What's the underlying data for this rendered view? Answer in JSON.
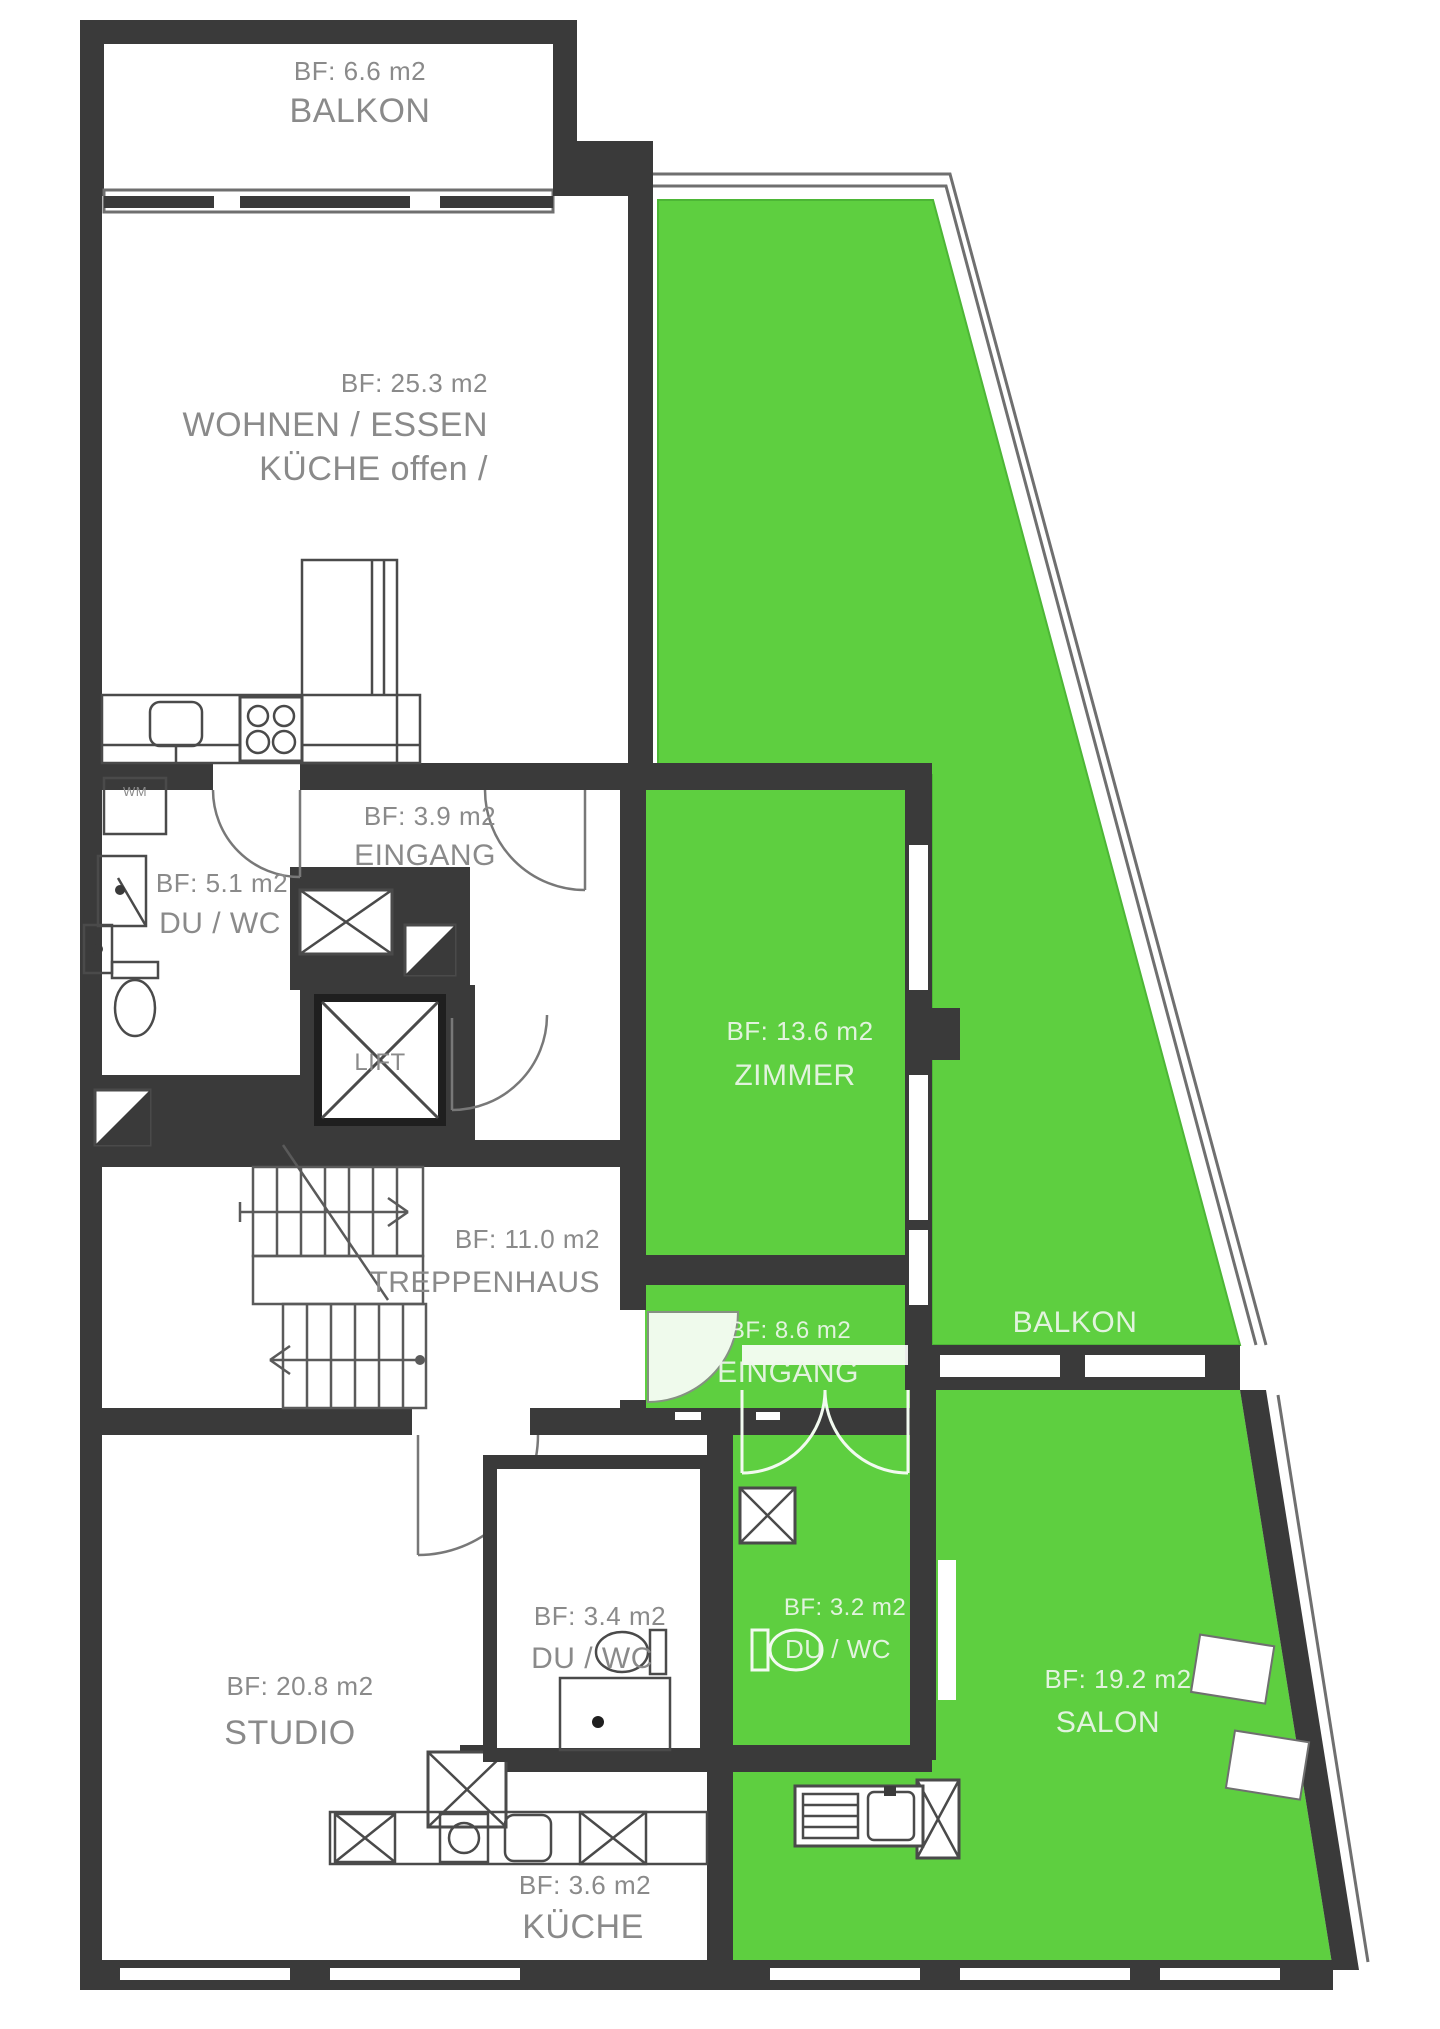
{
  "colors": {
    "green": "#5ecf40",
    "wall": "#3a3a3a",
    "outline": "#6f6f6f",
    "label_gray": "#8a8a8a",
    "label_white": "#eef7ec"
  },
  "rooms": {
    "balkon_top": {
      "area": "BF: 6.6 m2",
      "name": "BALKON"
    },
    "wohnen": {
      "area": "BF: 25.3 m2",
      "name": "WOHNEN / ESSEN",
      "name2": "KÜCHE offen /"
    },
    "eingang_top": {
      "area": "BF: 3.9 m2",
      "name": "EINGANG"
    },
    "du_wc_top": {
      "area": "BF: 5.1 m2",
      "name": "DU / WC"
    },
    "lift": {
      "name": "LIFT"
    },
    "treppenhaus": {
      "area": "BF: 11.0 m2",
      "name": "TREPPENHAUS"
    },
    "zimmer": {
      "area": "BF: 13.6 m2",
      "name": "ZIMMER"
    },
    "eingang_green": {
      "area": "BF: 8.6 m2",
      "name": "EINGANG"
    },
    "balkon_green": {
      "name": "BALKON"
    },
    "du_wc_small": {
      "area": "BF: 3.4 m2",
      "name": "DU / WC"
    },
    "du_wc_green": {
      "area": "BF: 3.2 m2",
      "name": "DU / WC"
    },
    "studio": {
      "area": "BF: 20.8 m2",
      "name": "STUDIO"
    },
    "kueche": {
      "area": "BF: 3.6 m2",
      "name": "KÜCHE"
    },
    "salon": {
      "area": "BF: 19.2 m2",
      "name": "SALON"
    },
    "wm": {
      "label": "WM"
    }
  }
}
